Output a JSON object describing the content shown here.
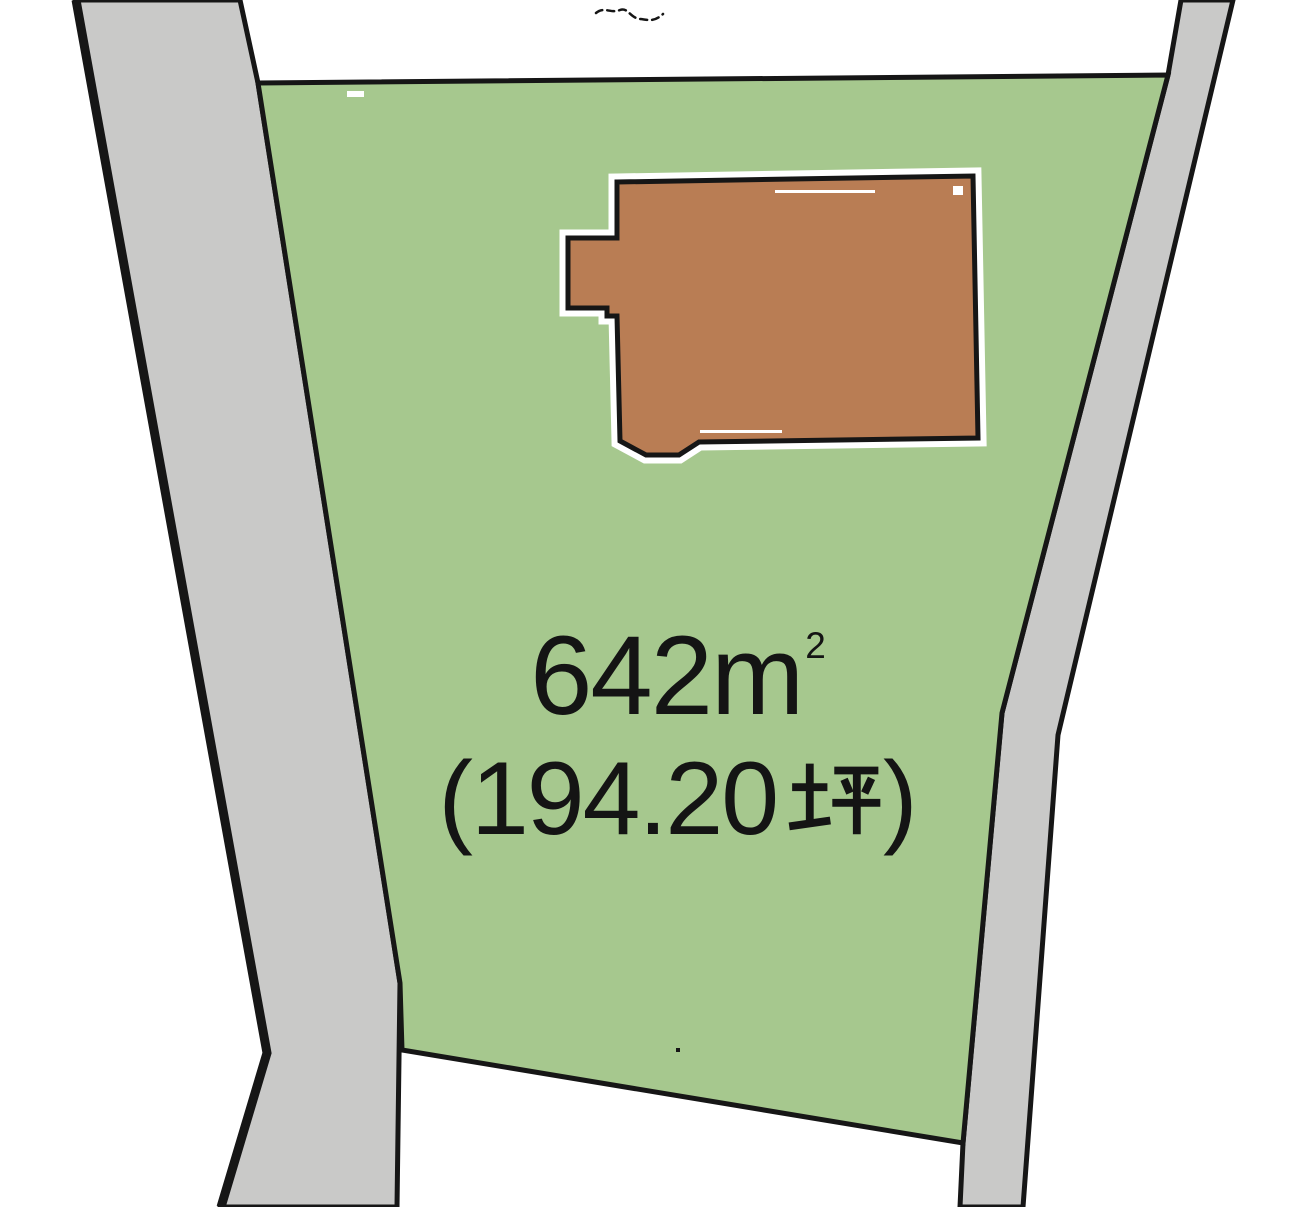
{
  "diagram": {
    "title": "land-plot-diagram",
    "colors": {
      "background": "#ffffff",
      "parcel_green": "#a6c88e",
      "road_gray": "#c9c9c8",
      "building_brown": "#b97d54",
      "outline_black": "#161616",
      "halo_white": "#ffffff",
      "text_black": "#141414"
    },
    "parcel": {
      "area_m2": {
        "full": "642㎡",
        "value": "642",
        "unit_base": "m",
        "unit_sup": "2"
      },
      "area_tsubo": {
        "full": "（194.20坪）",
        "open": "(",
        "value": "194.20",
        "unit": "坪",
        "close": ")"
      }
    }
  }
}
